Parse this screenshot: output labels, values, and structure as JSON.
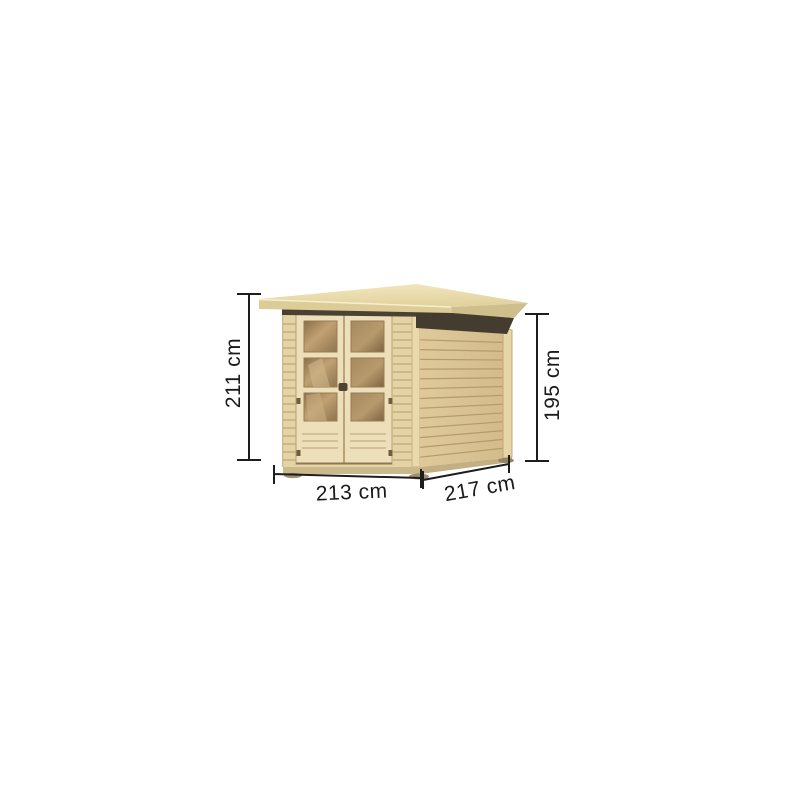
{
  "image": {
    "alt": "Wooden garden shed with double glazed doors and flat overhanging roof, annotated with dimension arrows",
    "background": "#ffffff"
  },
  "dimensions": {
    "overall_height": "211 cm",
    "wall_height": "195 cm",
    "front_width": "213 cm",
    "side_depth": "217 cm"
  },
  "colors": {
    "roof_top": "#eee3b6",
    "roof_front_edge": "#dccc98",
    "under_roof_shadow": "#4a4135",
    "wall_wood": "#e4d3a4",
    "side_wall_wood": "#d9c292",
    "wood_groove": "#b49a6c",
    "door_frame": "#ecdfba",
    "glass_tint": "#9a7f58",
    "base_wood": "#cbb98c",
    "dimension_line": "#1d1d1b",
    "background": "#ffffff"
  }
}
